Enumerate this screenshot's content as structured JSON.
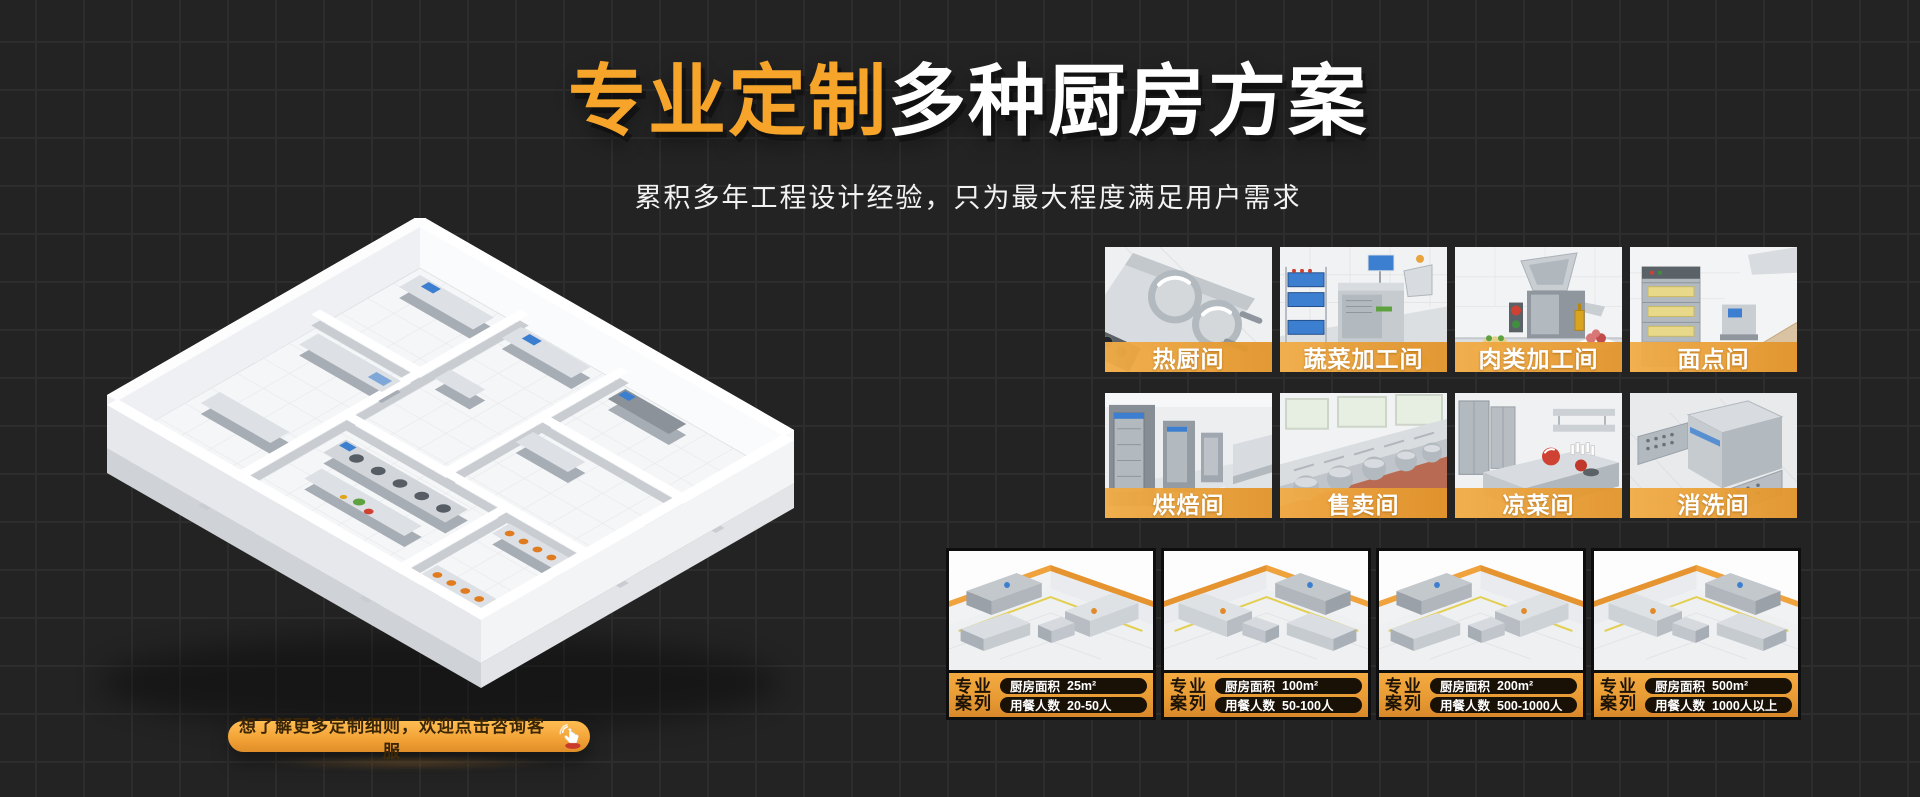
{
  "hero": {
    "title_highlight": "专业定制",
    "title_rest": "多种厨房方案",
    "subtitle": "累积多年工程设计经验，只为最大程度满足用户需求"
  },
  "cta": {
    "label": "想了解更多定制细则，欢迎点击咨询客服",
    "icon": "click-hand-icon"
  },
  "rooms": [
    {
      "label": "热厨间"
    },
    {
      "label": "蔬菜加工间"
    },
    {
      "label": "肉类加工间"
    },
    {
      "label": "面点间"
    },
    {
      "label": "烘焙间"
    },
    {
      "label": "售卖间"
    },
    {
      "label": "凉菜间"
    },
    {
      "label": "消洗间"
    }
  ],
  "cases": [
    {
      "tag_line1": "专业",
      "tag_line2": "案列",
      "area_label": "厨房面积",
      "area_value": "25m²",
      "diners_label": "用餐人数",
      "diners_value": "20-50人"
    },
    {
      "tag_line1": "专业",
      "tag_line2": "案列",
      "area_label": "厨房面积",
      "area_value": "100m²",
      "diners_label": "用餐人数",
      "diners_value": "50-100人"
    },
    {
      "tag_line1": "专业",
      "tag_line2": "案列",
      "area_label": "厨房面积",
      "area_value": "200m²",
      "diners_label": "用餐人数",
      "diners_value": "500-1000人"
    },
    {
      "tag_line1": "专业",
      "tag_line2": "案列",
      "area_label": "厨房面积",
      "area_value": "500m²",
      "diners_label": "用餐人数",
      "diners_value": "1000人以上"
    }
  ],
  "colors": {
    "title_orange": "#F7A52A",
    "accent_orange": "#E9A23C",
    "background": "#232323"
  }
}
